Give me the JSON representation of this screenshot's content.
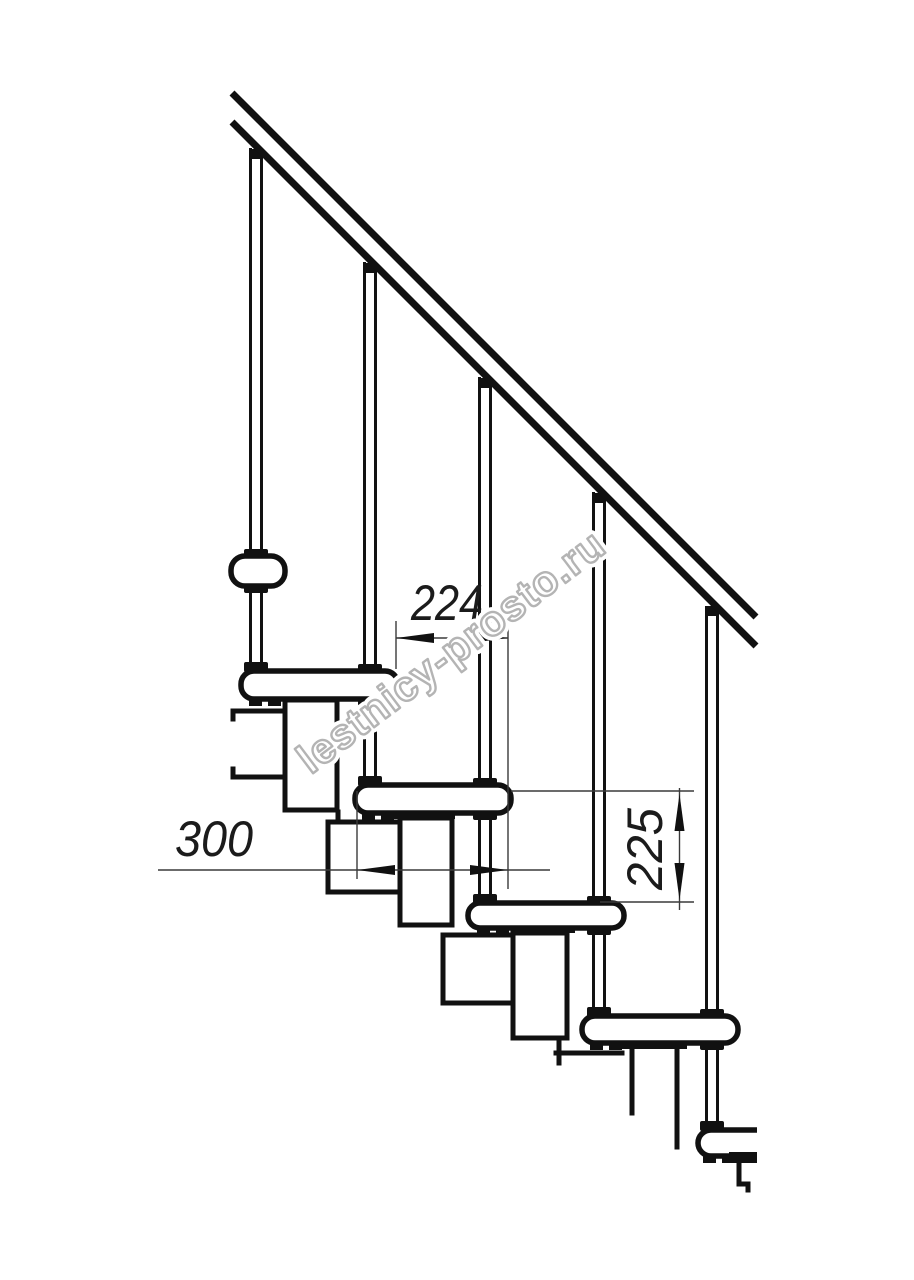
{
  "drawing": {
    "kind": "modular-staircase-side-view",
    "dimensions": {
      "step_run": "224",
      "tread_depth": "300",
      "step_rise": "225"
    },
    "watermark": {
      "text": "lestnicy-prosto.ru"
    },
    "colors": {
      "background": "#ffffff",
      "line": "#111111",
      "dimension_line": "#3a3a3a",
      "dimension_text": "#1b1b1b",
      "watermark_outline": "#b4b4b4",
      "watermark_fill": "#ffffff"
    }
  }
}
